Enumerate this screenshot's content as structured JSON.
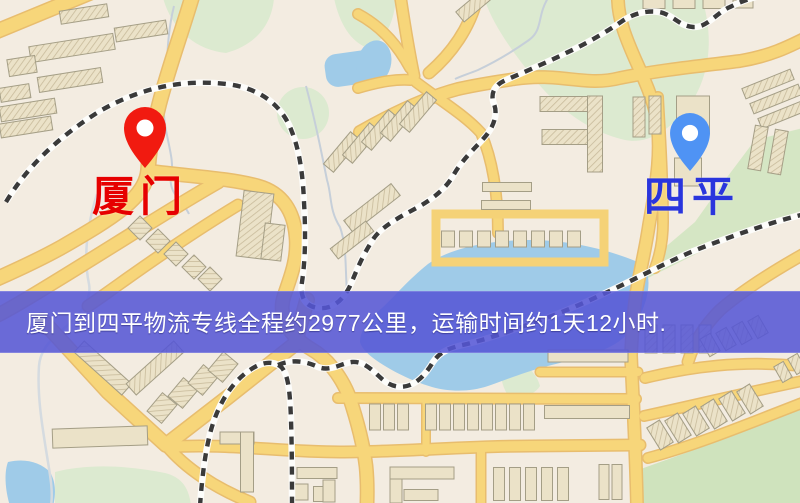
{
  "map": {
    "origin": {
      "label": "厦门",
      "marker_color": "#f11a10",
      "label_color": "#e60000"
    },
    "destination": {
      "label": "四平",
      "marker_color": "#4f93f4",
      "label_color": "#2a35dd"
    }
  },
  "banner": {
    "text": "厦门到四平物流专线全程约2977公里，运输时间约1天12小时.",
    "background_color": "#5556d6",
    "text_color": "#ffffff"
  },
  "palette": {
    "background": "#f3ece1",
    "road": "#f7d67a",
    "road_casing": "#e8bd6e",
    "building": "#ebe2c8",
    "building_line": "#c8bb9b",
    "green": "#dcead0",
    "water": "#9fcbe8",
    "railway": "#3a3a3a"
  }
}
